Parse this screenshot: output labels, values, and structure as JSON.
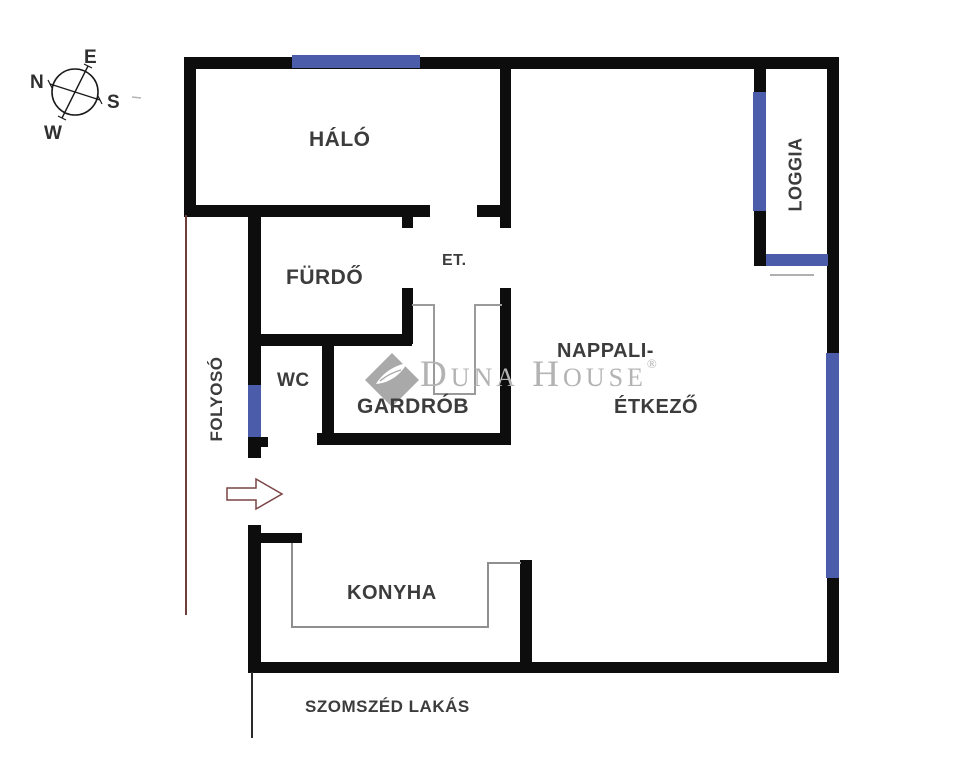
{
  "compass": {
    "north": "N",
    "east": "E",
    "south": "S",
    "west": "W"
  },
  "rooms": {
    "halo": "HÁLÓ",
    "furdo": "FÜRDŐ",
    "et": "ET.",
    "wc": "WC",
    "gardrob": "GARDRÓB",
    "folyoso": "FOLYOSÓ",
    "nappali_line1": "NAPPALI-",
    "nappali_line2": "ÉTKEZŐ",
    "konyha": "KONYHA",
    "loggia": "LOGGIA"
  },
  "annotations": {
    "neighbor_apartment": "SZOMSZÉD LAKÁS"
  },
  "watermark": {
    "brand": "Duna House",
    "registered": "®"
  },
  "colors": {
    "background": "#ffffff",
    "wall": "#0d0d0d",
    "window": "#4a5caa",
    "arrow_outline": "#7a4444",
    "boundary_line": "#703d3d",
    "counter_line": "#8f8f8f",
    "wardrobe_line": "#9a9a9a",
    "label_text": "#3c3c3c",
    "watermark_gray": "#b3b3b3"
  }
}
